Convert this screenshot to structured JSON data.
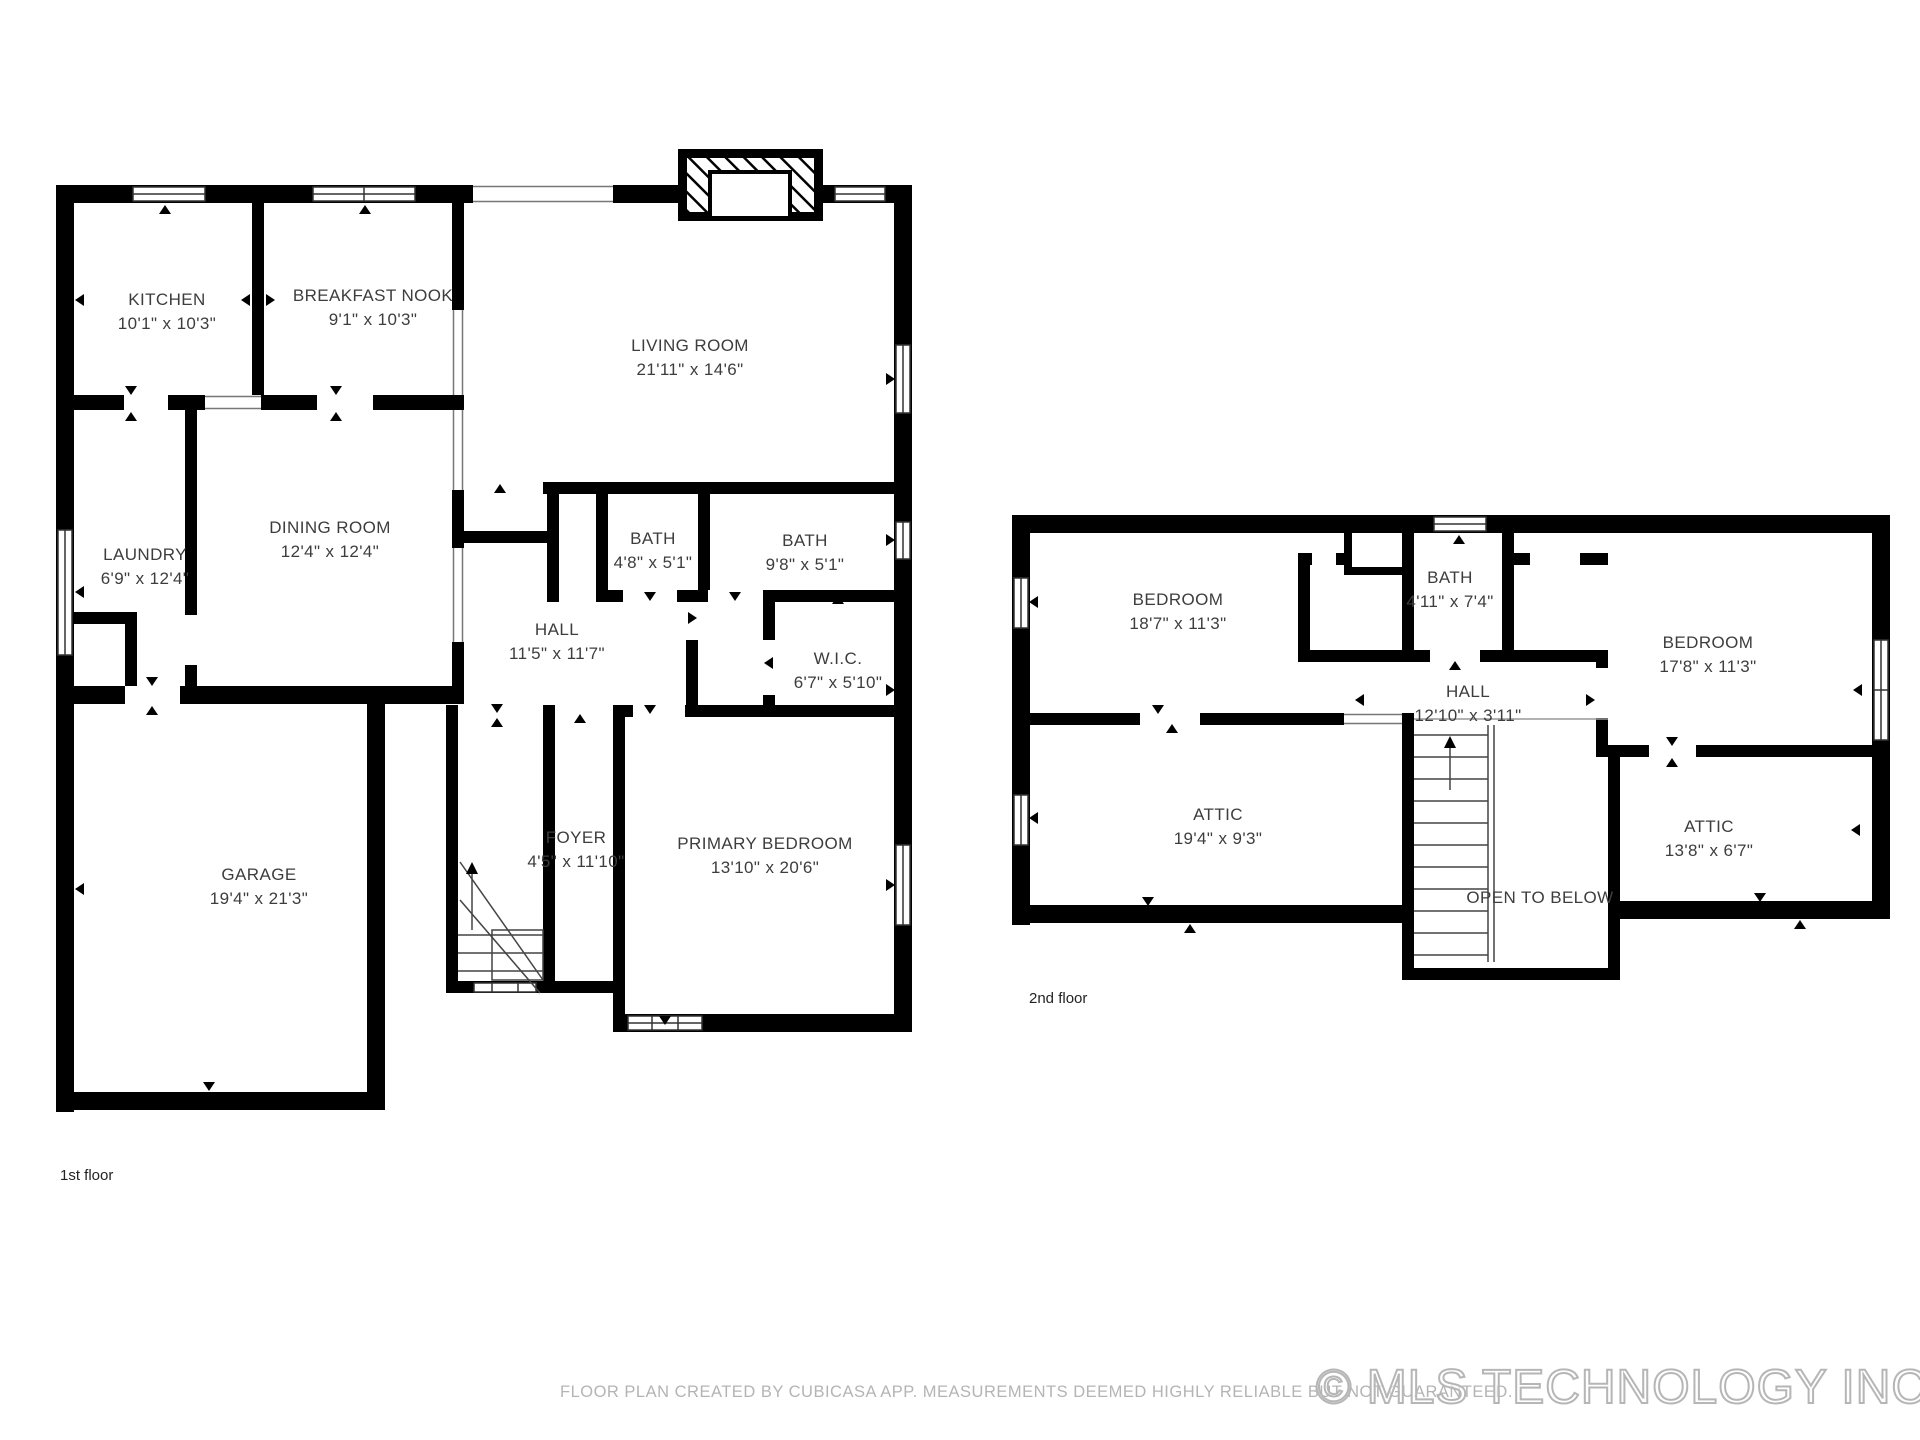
{
  "colors": {
    "wall": "#000000",
    "room_label": "#3d3d3d",
    "footer_text": "#b4b4b4",
    "watermark_outline": "#b6b6b6"
  },
  "floors": {
    "first": {
      "label": "1st floor",
      "rooms": {
        "kitchen": {
          "name": "KITCHEN",
          "dims": "10'1\" x 10'3\""
        },
        "breakfast_nook": {
          "name": "BREAKFAST NOOK",
          "dims": "9'1\" x 10'3\""
        },
        "living_room": {
          "name": "LIVING ROOM",
          "dims": "21'11\" x 14'6\""
        },
        "laundry": {
          "name": "LAUNDRY",
          "dims": "6'9\" x 12'4\""
        },
        "dining_room": {
          "name": "DINING ROOM",
          "dims": "12'4\" x 12'4\""
        },
        "bath_small": {
          "name": "BATH",
          "dims": "4'8\" x 5'1\""
        },
        "bath_large": {
          "name": "BATH",
          "dims": "9'8\" x 5'1\""
        },
        "hall": {
          "name": "HALL",
          "dims": "11'5\" x 11'7\""
        },
        "wic": {
          "name": "W.I.C.",
          "dims": "6'7\" x 5'10\""
        },
        "foyer": {
          "name": "FOYER",
          "dims": "4'5\" x 11'10\""
        },
        "garage": {
          "name": "GARAGE",
          "dims": "19'4\" x 21'3\""
        },
        "primary_bedroom": {
          "name": "PRIMARY BEDROOM",
          "dims": "13'10\" x 20'6\""
        }
      }
    },
    "second": {
      "label": "2nd floor",
      "rooms": {
        "bedroom_left": {
          "name": "BEDROOM",
          "dims": "18'7\" x 11'3\""
        },
        "bath": {
          "name": "BATH",
          "dims": "4'11\" x 7'4\""
        },
        "bedroom_right": {
          "name": "BEDROOM",
          "dims": "17'8\" x 11'3\""
        },
        "hall": {
          "name": "HALL",
          "dims": "12'10\" x 3'11\""
        },
        "attic_left": {
          "name": "ATTIC",
          "dims": "19'4\" x 9'3\""
        },
        "attic_right": {
          "name": "ATTIC",
          "dims": "13'8\" x 6'7\""
        },
        "open_to_below": {
          "name": "OPEN TO BELOW"
        }
      }
    }
  },
  "footer": {
    "disclaimer": "FLOOR PLAN CREATED BY CUBICASA APP. MEASUREMENTS DEEMED HIGHLY RELIABLE BUT NOT GUARANTEED.",
    "watermark": "© MLS TECHNOLOGY INC 2025"
  }
}
